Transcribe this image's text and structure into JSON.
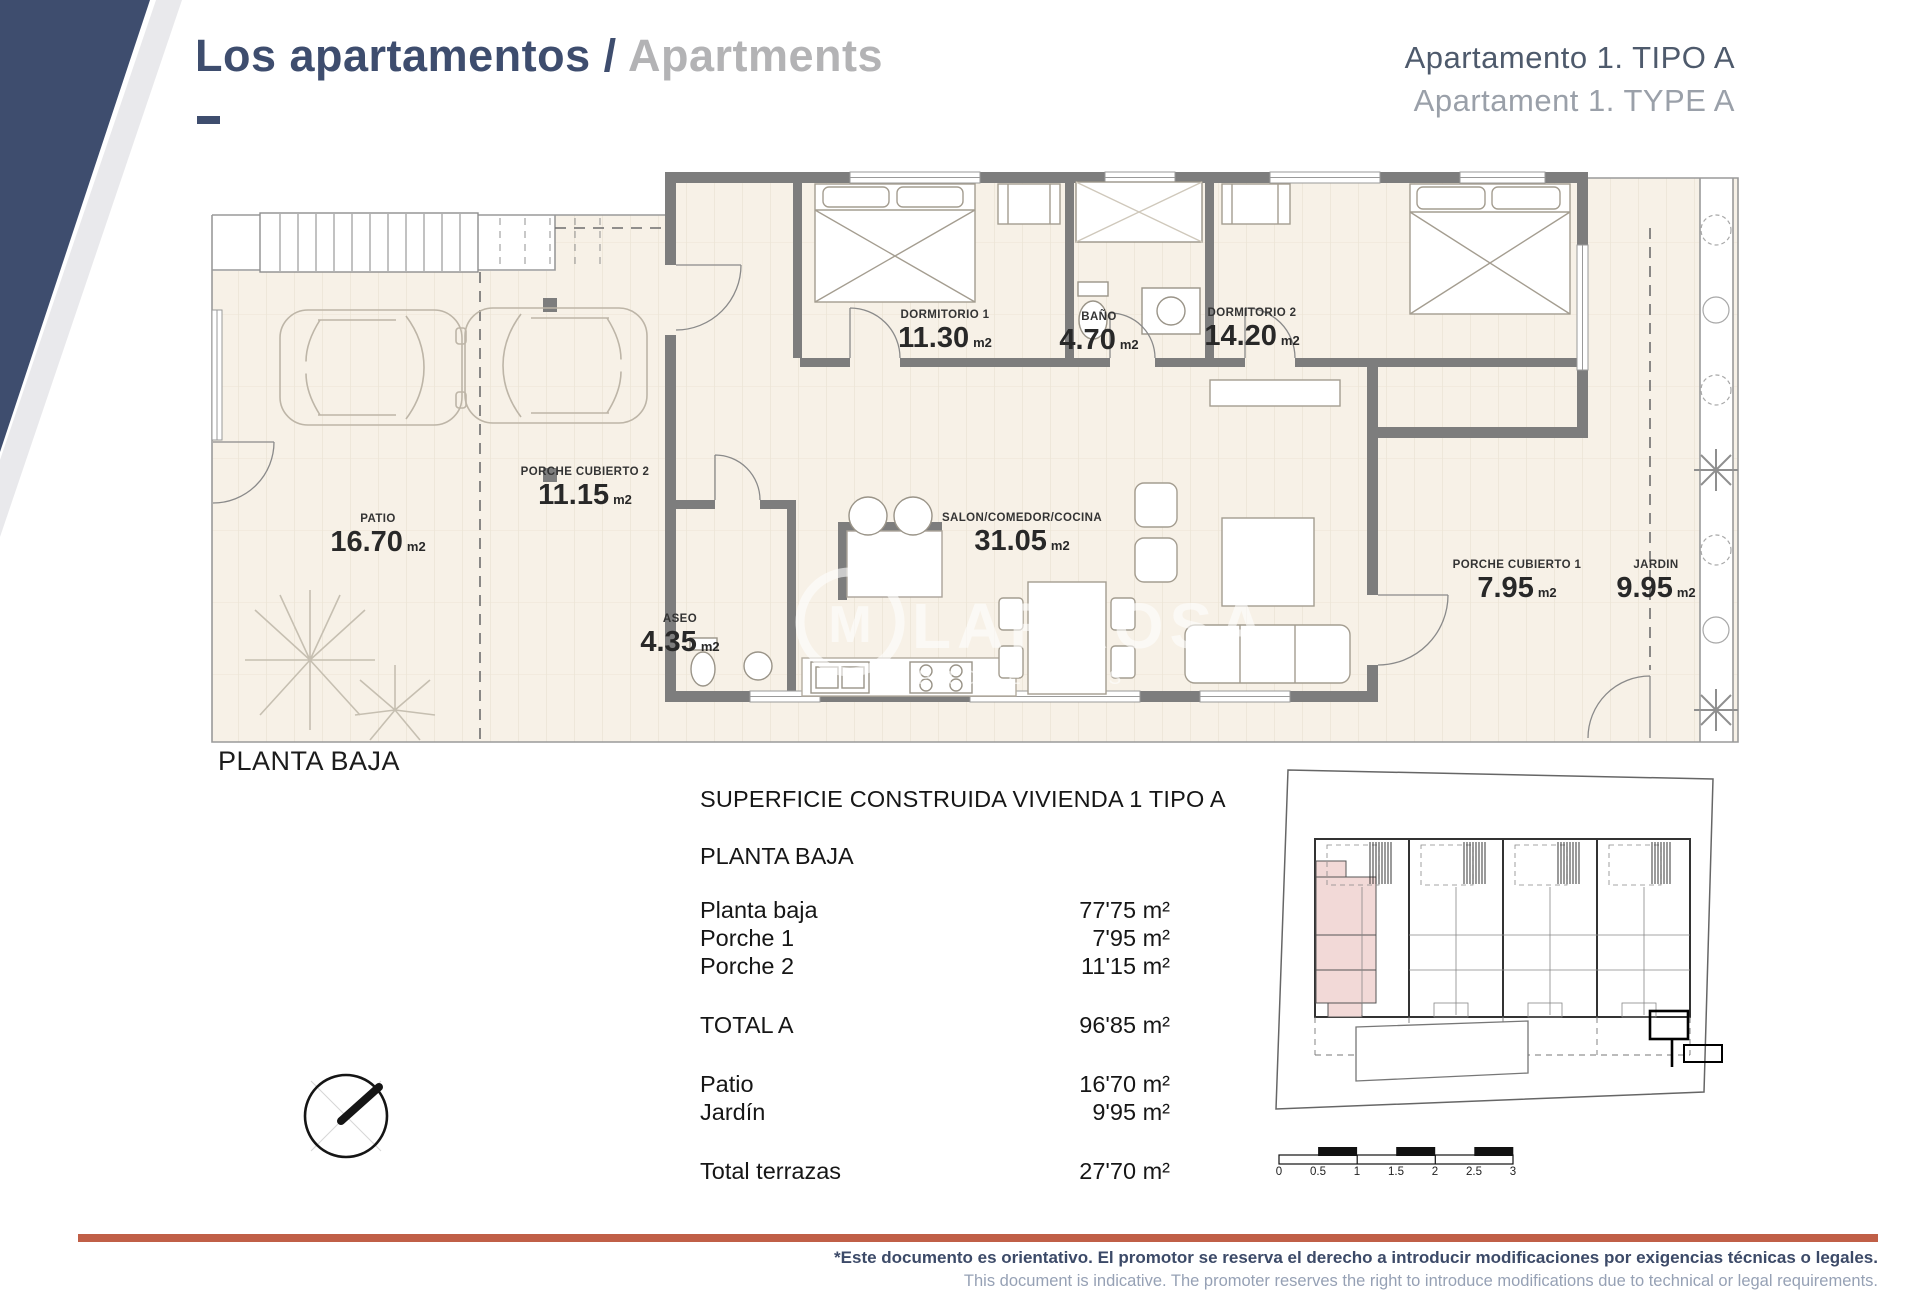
{
  "header": {
    "title_primary": "Los apartamentos /",
    "title_secondary": "Apartments",
    "apartment_line1": "Apartamento 1. TIPO A",
    "apartment_line2": "Apartament 1. TYPE A"
  },
  "floorplan": {
    "caption": "PLANTA BAJA",
    "unit": "m2",
    "watermark": {
      "name": "LARROSA",
      "sub": "PROPERTIES"
    },
    "rooms": [
      {
        "name": "PATIO",
        "area": "16.70",
        "x": 168,
        "y": 352
      },
      {
        "name": "PORCHE CUBIERTO 2",
        "area": "11.15",
        "x": 375,
        "y": 305
      },
      {
        "name": "DORMITORIO 1",
        "area": "11.30",
        "x": 735,
        "y": 148
      },
      {
        "name": "BAÑO",
        "area": "4.70",
        "x": 889,
        "y": 150
      },
      {
        "name": "DORMITORIO 2",
        "area": "14.20",
        "x": 1042,
        "y": 146
      },
      {
        "name": "ASEO",
        "area": "4.35",
        "x": 470,
        "y": 452
      },
      {
        "name": "SALON/COMEDOR/COCINA",
        "area": "31.05",
        "x": 812,
        "y": 351
      },
      {
        "name": "PORCHE CUBIERTO 1",
        "area": "7.95",
        "x": 1307,
        "y": 398
      },
      {
        "name": "JARDIN",
        "area": "9.95",
        "x": 1446,
        "y": 398
      }
    ]
  },
  "surface_table": {
    "title": "SUPERFICIE CONSTRUIDA VIVIENDA 1 TIPO A",
    "subtitle": "PLANTA BAJA",
    "rows": [
      {
        "label": "Planta baja",
        "value": "77'75 m²"
      },
      {
        "label": "Porche 1",
        "value": "7'95 m²"
      },
      {
        "label": "Porche 2",
        "value": "11'15 m²",
        "gap_after": true
      },
      {
        "label": "TOTAL A",
        "value": "96'85 m²",
        "gap_after": true
      },
      {
        "label": "Patio",
        "value": "16'70 m²"
      },
      {
        "label": "Jardín",
        "value": "9'95 m²",
        "gap_after": true
      },
      {
        "label": "Total terrazas",
        "value": "27'70 m²"
      }
    ]
  },
  "scalebar": {
    "ticks": [
      "0",
      "0.5",
      "1",
      "1.5",
      "2",
      "2.5",
      "3"
    ]
  },
  "footer": {
    "line1": "*Este documento es orientativo. El promotor se reserva el derecho a introducir modificaciones por exigencias técnicas o legales.",
    "line2": "This document is indicative. The promoter reserves the right to introduce modifications due to technical or legal requirements."
  },
  "colors": {
    "navy": "#3e4d6e",
    "title_gray": "#b3b3b5",
    "apartment_subtitle_gray": "#9aa0a9",
    "orange_rule": "#c05f47",
    "footer_blue": "#3c4a68",
    "footer_gray": "#96a1b5",
    "floor_cream": "#f7f1e7",
    "wall_gray": "#7d7d7d",
    "highlight_pink": "#f2d9d7"
  }
}
